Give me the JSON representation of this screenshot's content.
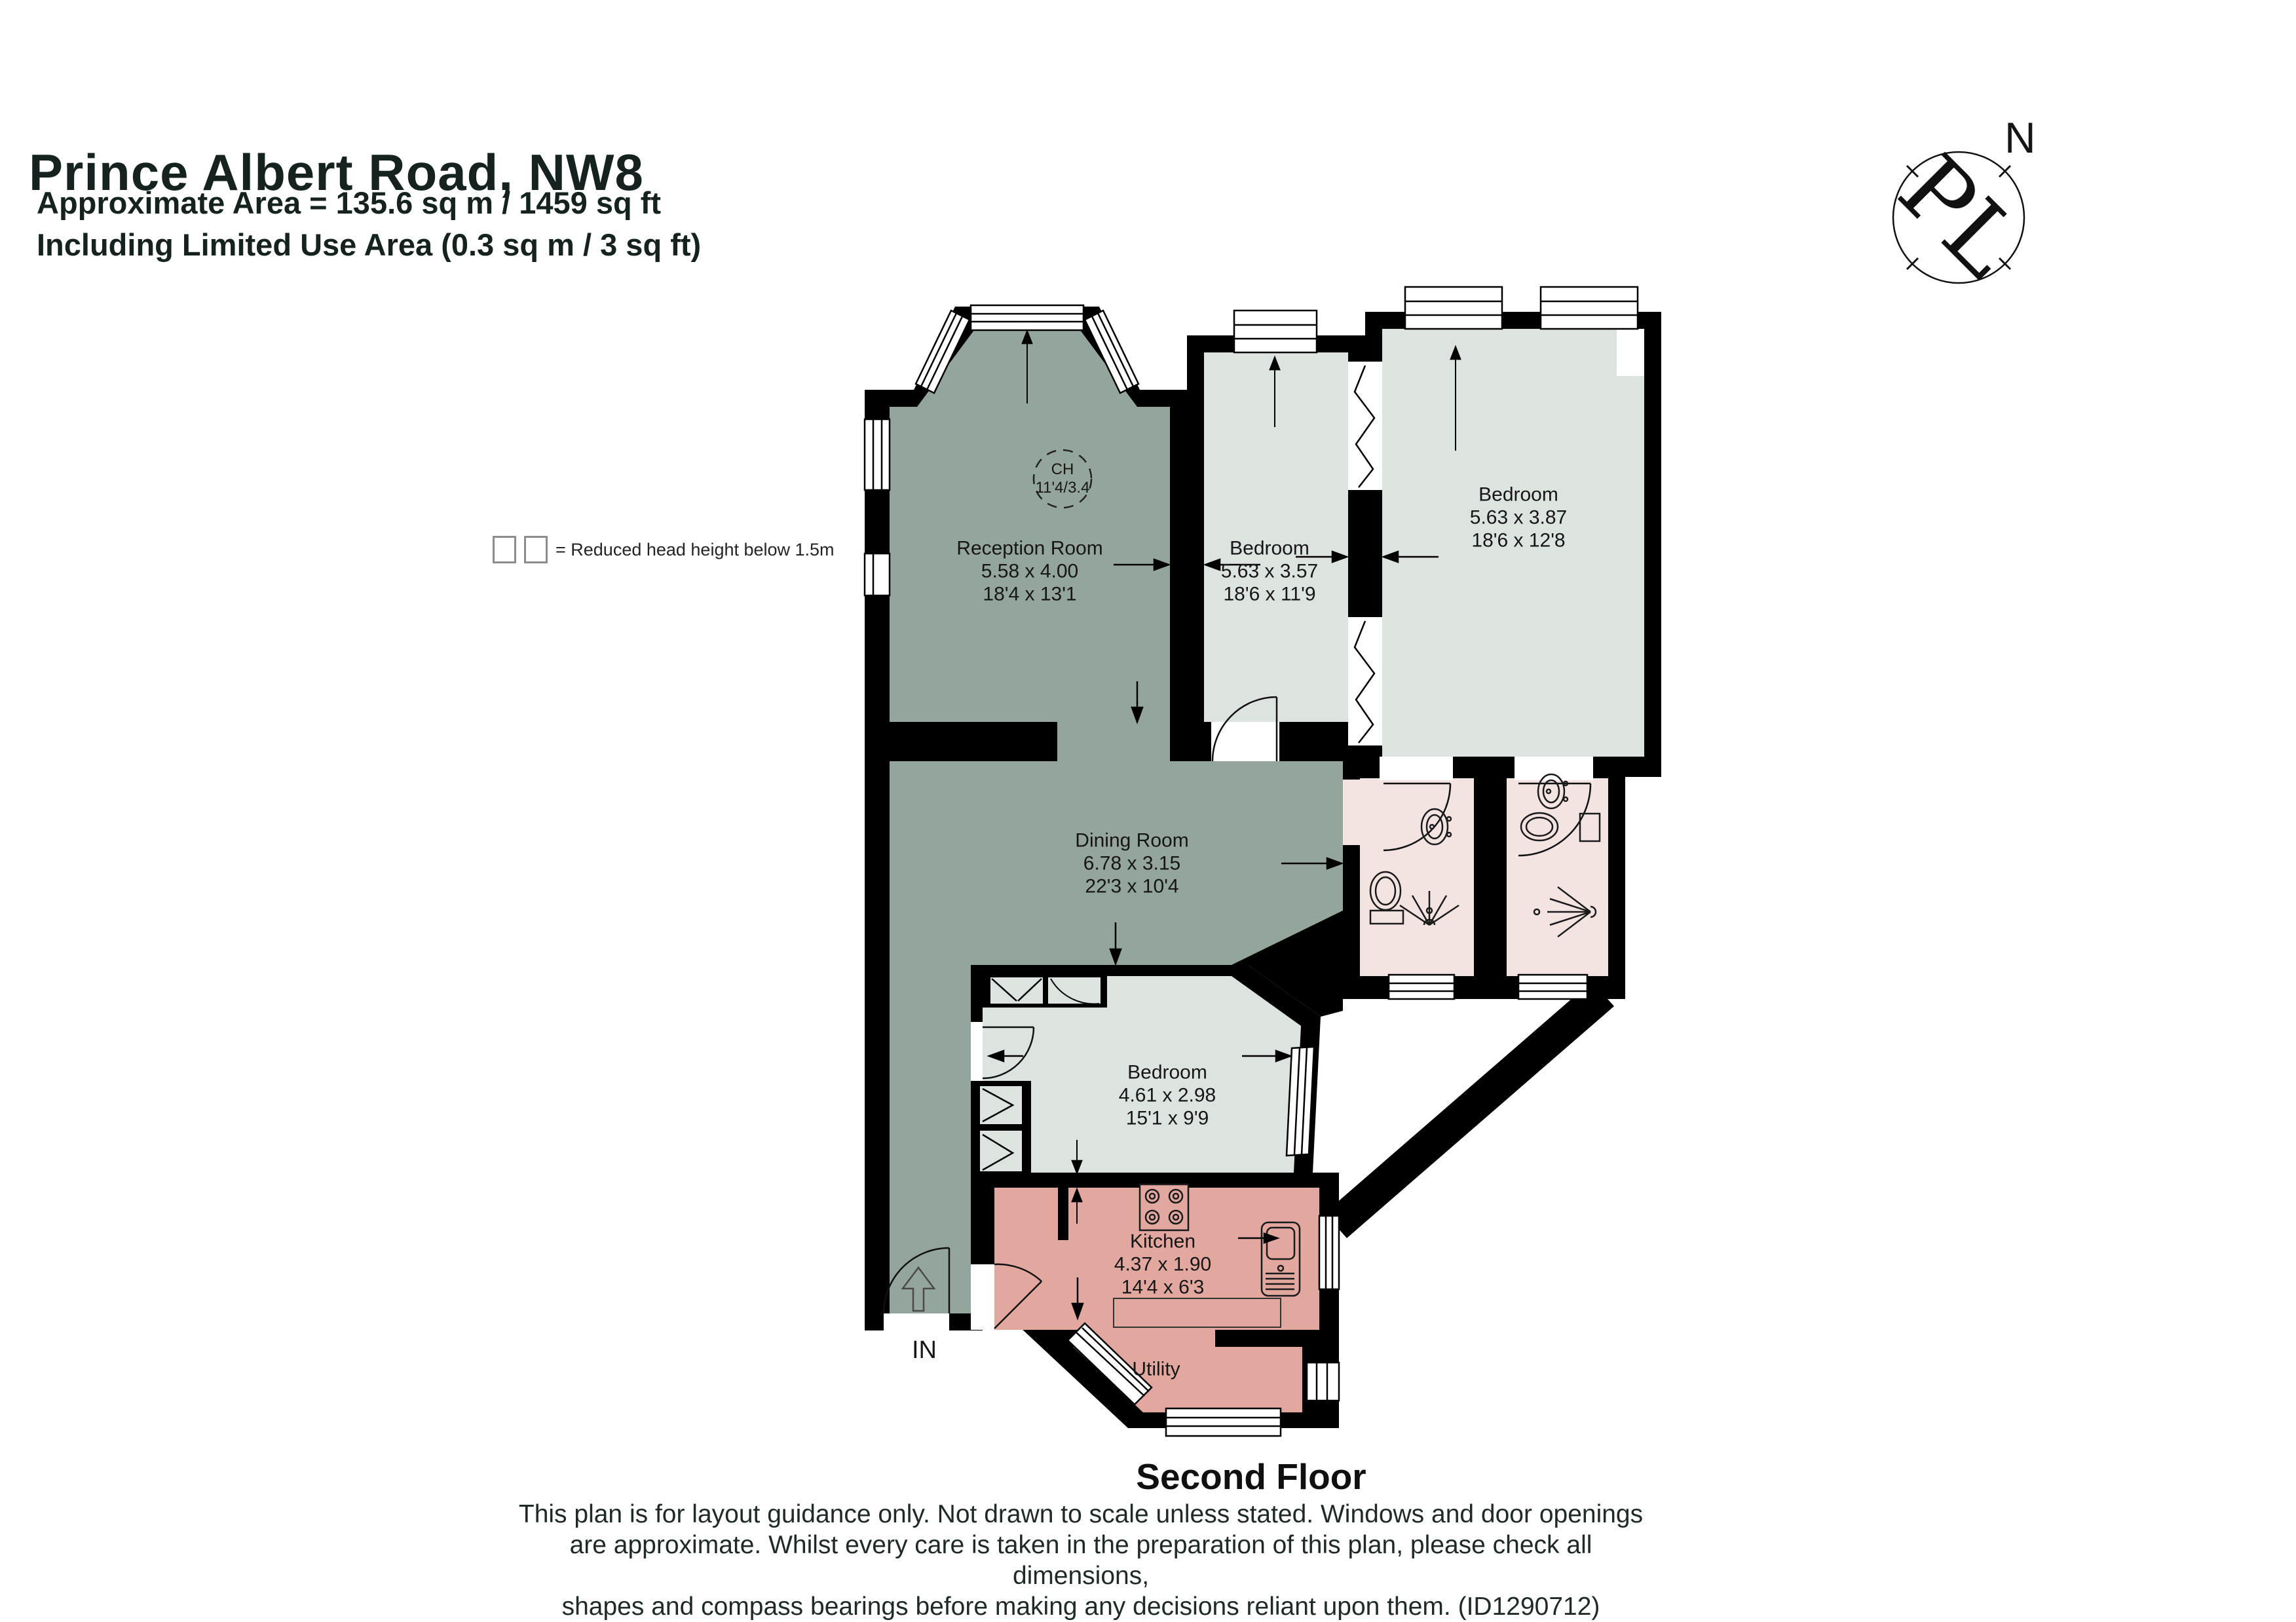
{
  "header": {
    "title": "Prince Albert Road, NW8",
    "area_line1": "Approximate Area = 135.6 sq m / 1459 sq ft",
    "area_line2": "Including Limited Use Area (0.3 sq m / 3 sq ft)"
  },
  "compass": {
    "north_label": "N",
    "logo": "PL"
  },
  "legend": {
    "text": "= Reduced head height below 1.5m"
  },
  "rooms": [
    {
      "name": "Reception Room",
      "metric": "5.58 x 4.00",
      "imperial": "18'4 x 13'1"
    },
    {
      "name": "Bedroom",
      "metric": "5.63 x 3.57",
      "imperial": "18'6 x 11'9"
    },
    {
      "name": "Bedroom",
      "metric": "5.63 x 3.87",
      "imperial": "18'6 x 12'8"
    },
    {
      "name": "Dining Room",
      "metric": "6.78 x 3.15",
      "imperial": "22'3 x 10'4"
    },
    {
      "name": "Bedroom",
      "metric": "4.61 x 2.98",
      "imperial": "15'1 x 9'9"
    },
    {
      "name": "Kitchen",
      "metric": "4.37 x 1.90",
      "imperial": "14'4 x 6'3"
    },
    {
      "name": "Utility"
    }
  ],
  "annotations": {
    "ceiling_height_line1": "CH",
    "ceiling_height_line2": "11'4/3.4",
    "entrance_label": "IN"
  },
  "floor": {
    "label": "Second Floor"
  },
  "disclaimer": {
    "line1": "This plan is for layout guidance only. Not drawn to scale unless stated. Windows and door openings",
    "line2": "are approximate. Whilst every care is taken in the preparation of this plan, please check all dimensions,",
    "line3": "shapes and compass bearings before making any decisions reliant upon them. (ID1290712)"
  },
  "colors": {
    "reception_dining": "#94a69b",
    "bedroom": "#dde4e0",
    "bathroom": "#f3e4e2",
    "kitchen_utility": "#e2a8a0",
    "wall": "#000000"
  }
}
